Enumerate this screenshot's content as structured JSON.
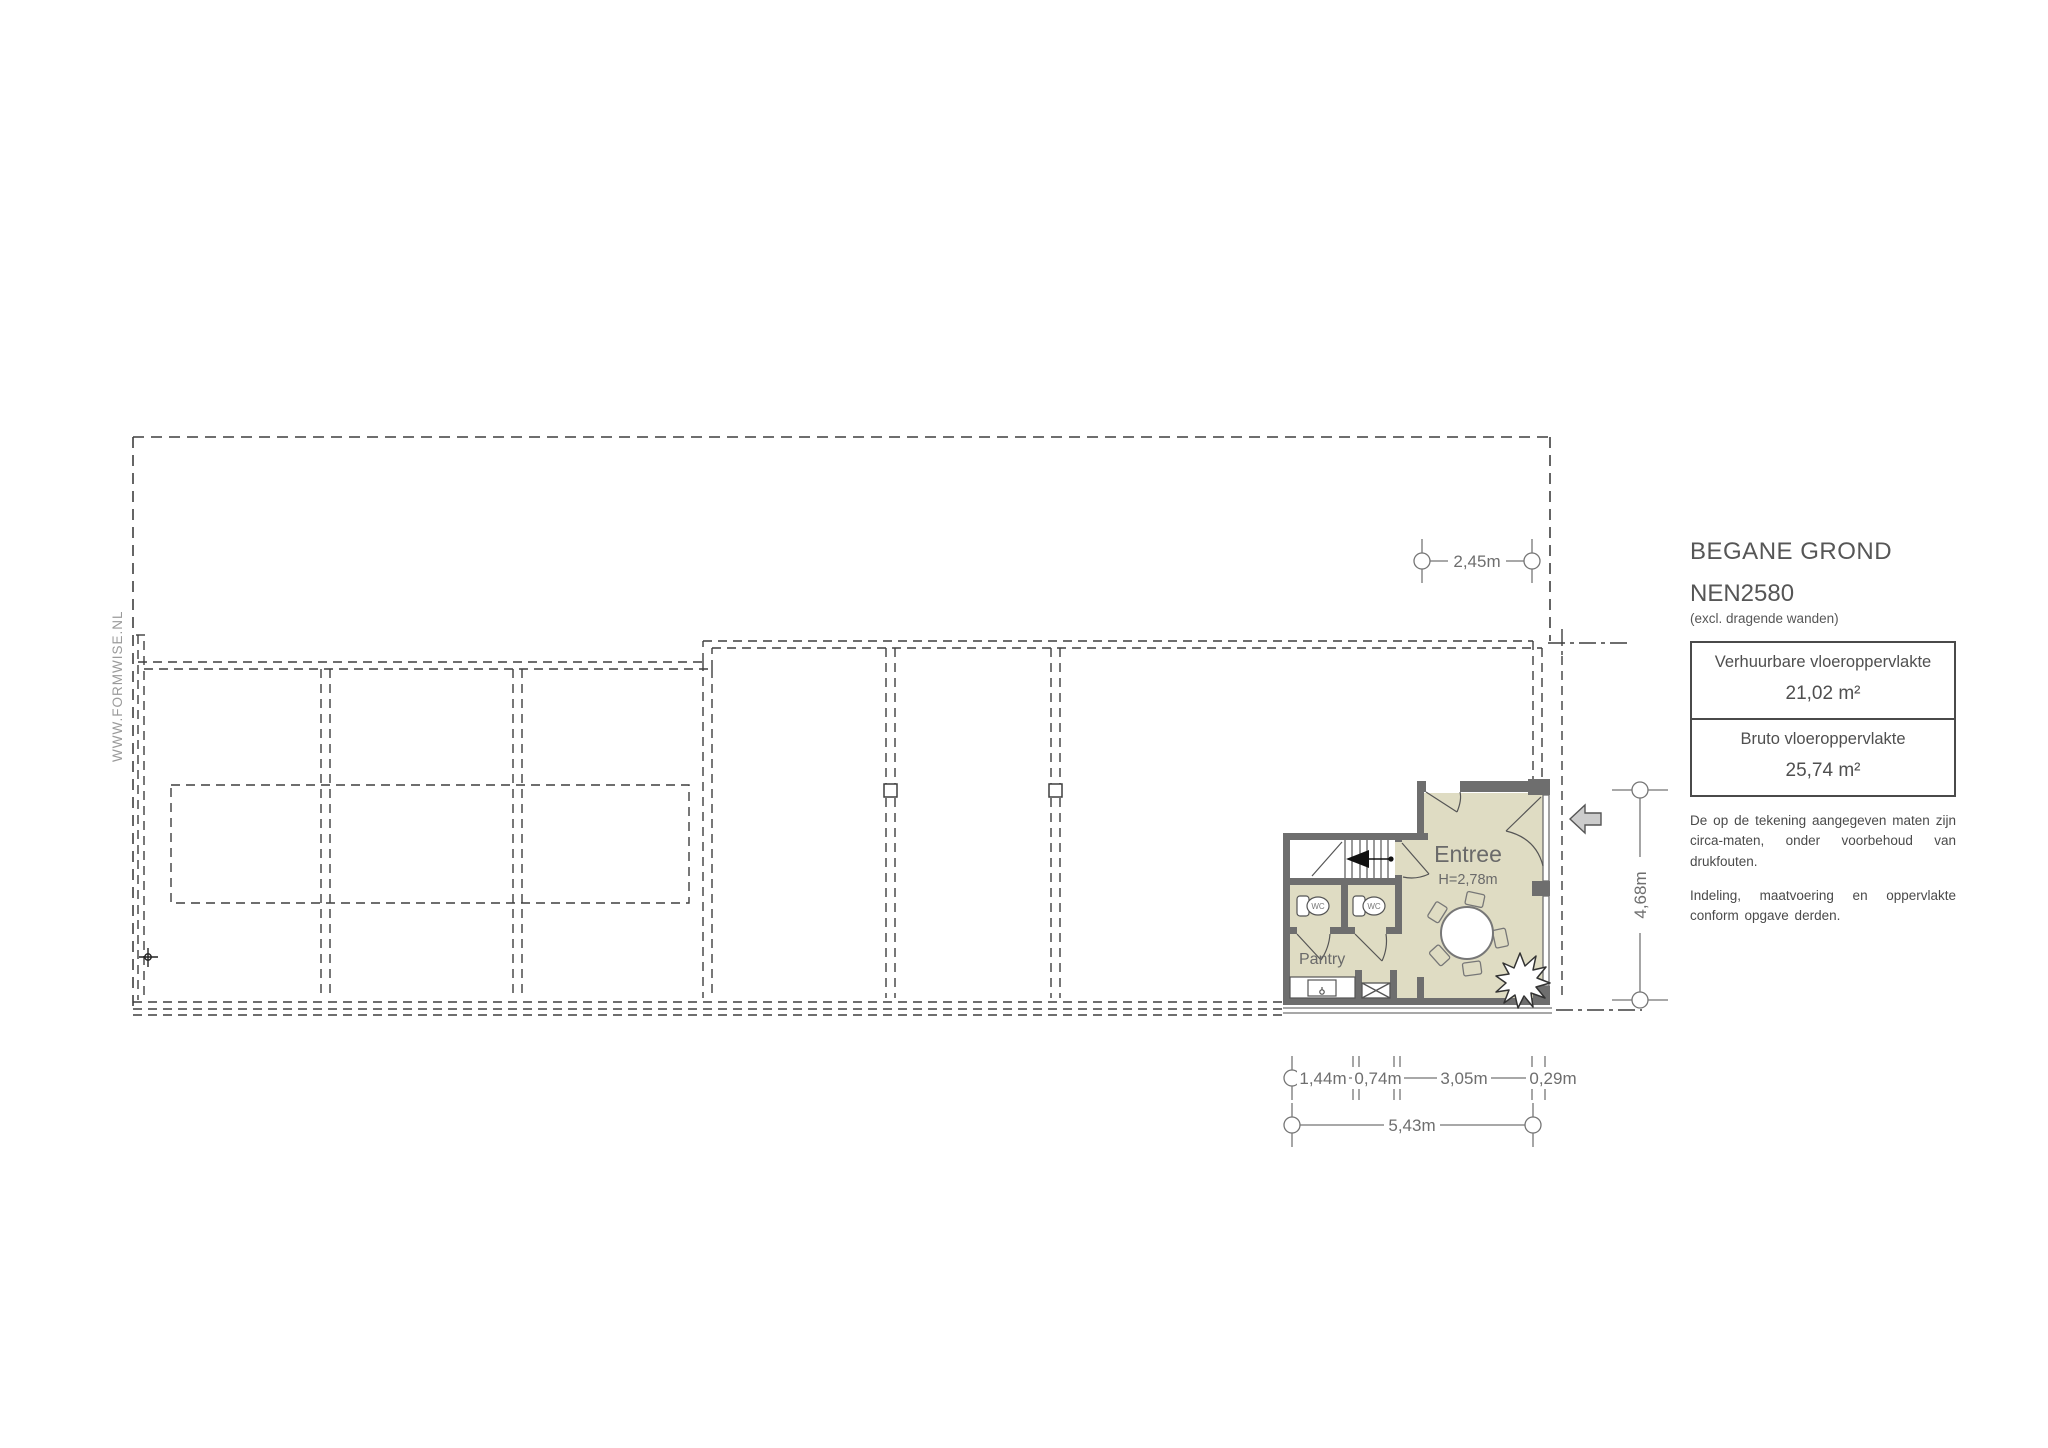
{
  "watermark": "WWW.FORMWISE.NL",
  "plan": {
    "room_entree": "Entree",
    "room_entree_height": "H=2,78m",
    "room_pantry": "Pantry",
    "wc_label": "WC"
  },
  "dimensions": {
    "top_width": "2,45m",
    "right_height": "4,68m",
    "bottom_seg_1": "1,44m",
    "bottom_seg_2": "0,74m",
    "bottom_seg_3": "3,05m",
    "bottom_seg_4": "0,29m",
    "bottom_total": "5,43m"
  },
  "title_block": {
    "title": "BEGANE GROND",
    "standard": "NEN2580",
    "standard_note": "(excl. dragende wanden)",
    "area_table": {
      "row1_label": "Verhuurbare vloeroppervlakte",
      "row1_value": "21,02 m²",
      "row2_label": "Bruto vloeroppervlakte",
      "row2_value": "25,74 m²"
    },
    "disclaimer_1": "De op de tekening aangegeven maten zijn circa-maten, onder voorbehoud van drukfouten.",
    "disclaimer_2": "Indeling, maatvoering en oppervlakte conform opgave derden."
  },
  "colors": {
    "floor_fill": "#dfdcc3",
    "wall": "#6e6e6e",
    "dash_line": "#3f3f3f",
    "dimension": "#757575",
    "text_gray": "#595959"
  }
}
